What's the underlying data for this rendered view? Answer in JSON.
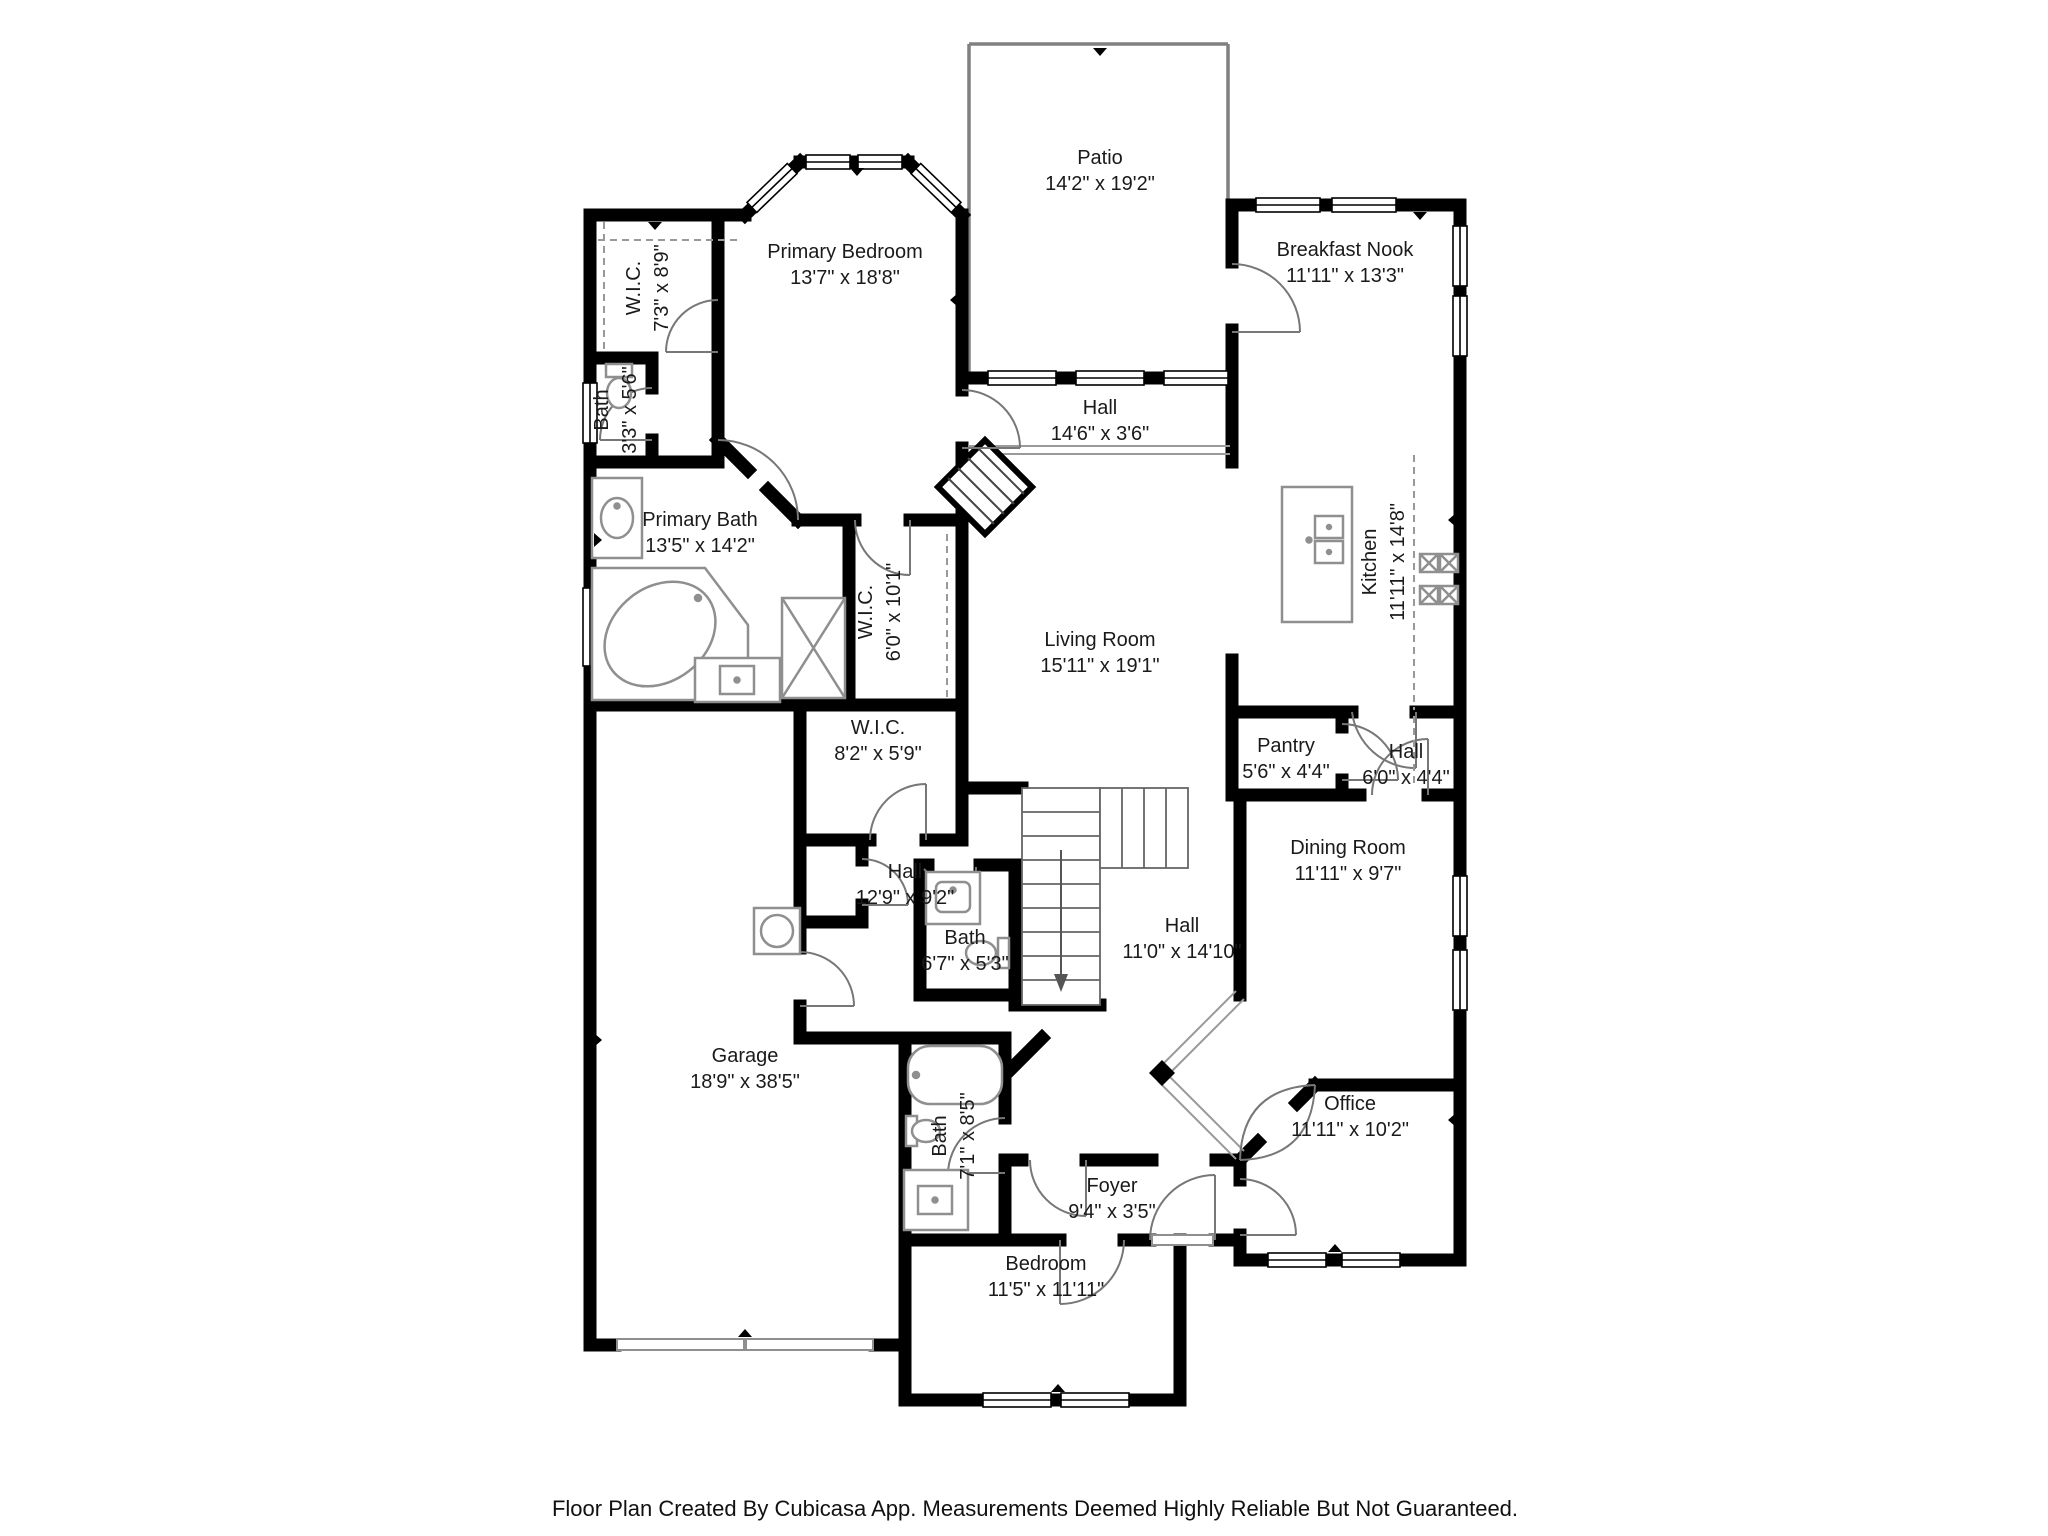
{
  "caption": "Floor Plan Created By Cubicasa App. Measurements Deemed Highly Reliable But Not Guaranteed.",
  "colors": {
    "wall": "#000000",
    "fixture_outline": "#8f8f8f",
    "door_arc": "#777777",
    "label_text": "#1a1a1a",
    "caption_text": "#111111"
  },
  "rooms": [
    {
      "name": "Patio",
      "dims": "14'2\" x 19'2\""
    },
    {
      "name": "Primary Bedroom",
      "dims": "13'7\" x 18'8\""
    },
    {
      "name": "W.I.C.",
      "dims": "7'3\" x 8'9\""
    },
    {
      "name": "Bath",
      "dims": "3'3\" x 5'6\""
    },
    {
      "name": "Breakfast Nook",
      "dims": "11'11\" x 13'3\""
    },
    {
      "name": "Hall",
      "dims": "14'6\" x 3'6\""
    },
    {
      "name": "Primary Bath",
      "dims": "13'5\" x 14'2\""
    },
    {
      "name": "W.I.C.",
      "dims": "6'0\" x 10'1\""
    },
    {
      "name": "Kitchen",
      "dims": "11'11\" x 14'8\""
    },
    {
      "name": "Living Room",
      "dims": "15'11\" x 19'1\""
    },
    {
      "name": "W.I.C.",
      "dims": "8'2\" x 5'9\""
    },
    {
      "name": "Pantry",
      "dims": "5'6\" x 4'4\""
    },
    {
      "name": "Hall",
      "dims": "6'0\" x 4'4\""
    },
    {
      "name": "Hall",
      "dims": "12'9\" x 9'2\""
    },
    {
      "name": "Dining Room",
      "dims": "11'11\" x 9'7\""
    },
    {
      "name": "Bath",
      "dims": "6'7\" x 5'3\""
    },
    {
      "name": "Hall",
      "dims": "11'0\" x 14'10\""
    },
    {
      "name": "Bath",
      "dims": "7'1\" x 8'5\""
    },
    {
      "name": "Foyer",
      "dims": "9'4\" x 3'5\""
    },
    {
      "name": "Office",
      "dims": "11'11\" x 10'2\""
    },
    {
      "name": "Garage",
      "dims": "18'9\" x 38'5\""
    },
    {
      "name": "Bedroom",
      "dims": "11'5\" x 11'11\""
    }
  ]
}
